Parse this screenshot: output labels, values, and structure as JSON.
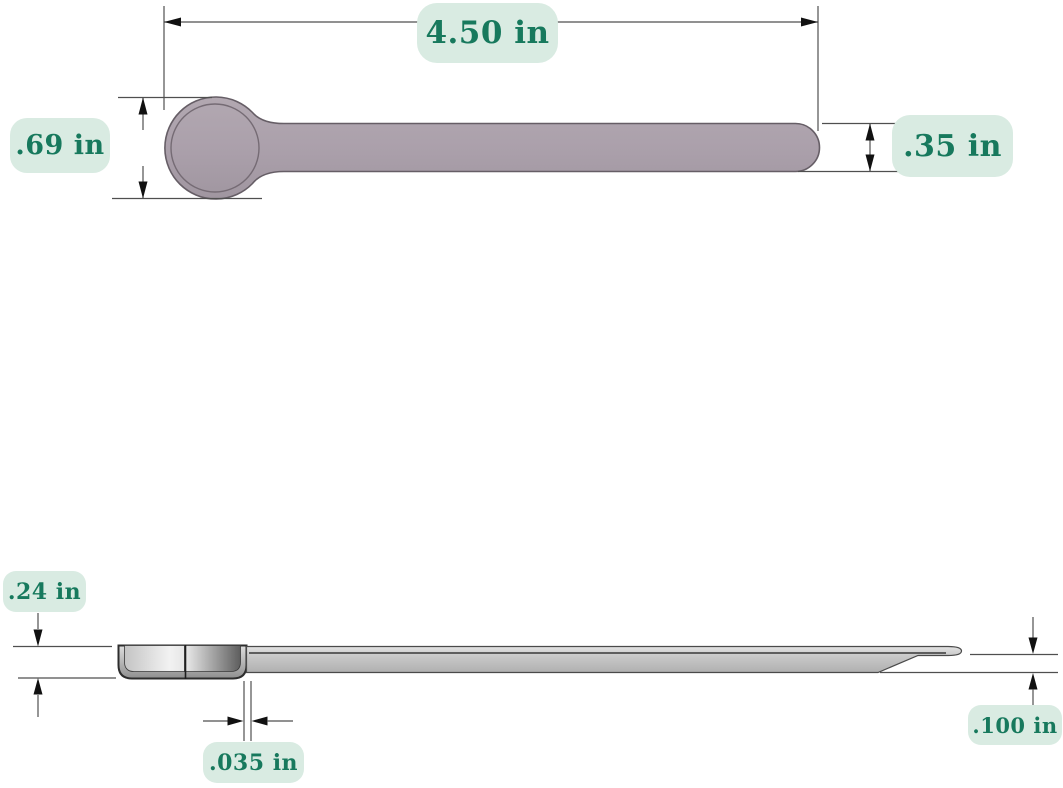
{
  "colors": {
    "background": "#ffffff",
    "label_background": "#d9ebe2",
    "label_text": "#17795d",
    "part_top_view_fill": "#aba0ab",
    "part_top_view_outline": "#665e66",
    "part_side_view_fill": "#c6c6c6",
    "part_side_view_outline": "#3a3a3a",
    "dimension_lines": "#4f4f4f"
  },
  "dimensions": [
    {
      "id": "overall-length",
      "view": "top",
      "label": "4.50 in"
    },
    {
      "id": "head-diameter",
      "view": "top",
      "label": ".69 in"
    },
    {
      "id": "handle-width",
      "view": "top",
      "label": ".35 in"
    },
    {
      "id": "head-depth",
      "view": "side",
      "label": ".24 in"
    },
    {
      "id": "wall-thickness",
      "view": "side",
      "label": ".035 in"
    },
    {
      "id": "handle-thickness",
      "view": "side",
      "label": ".100 in"
    }
  ]
}
